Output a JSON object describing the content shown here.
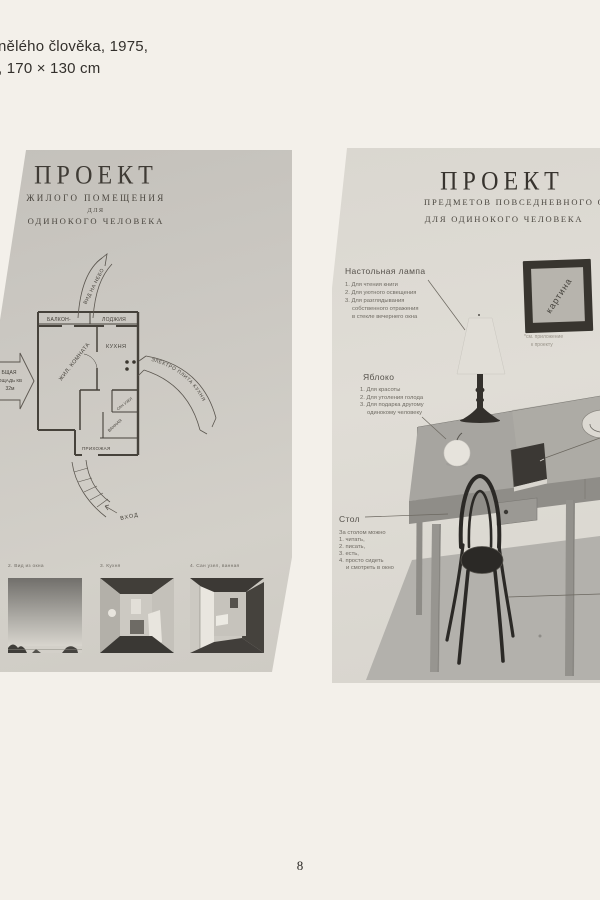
{
  "colors": {
    "page_bg": "#f3f0ea",
    "panel_left_bg": "#c9c6c0",
    "panel_right_bg": "#dedbd4",
    "ink": "#3c3833",
    "faint_ink": "#6b675f"
  },
  "caption": {
    "line1": "nělého člověka, 1975,",
    "line2": ", 170 × 130 cm"
  },
  "page_number": "8",
  "left_artwork": {
    "title": "ПРОЕКТ",
    "subtitle_line1": "ЖИЛОГО  ПОМЕЩЕНИЯ",
    "subtitle_line2": "ДЛЯ",
    "subtitle_line3": "ОДИНОКОГО ЧЕЛОВЕКА",
    "plan": {
      "balcony": "БАЛКОН-",
      "loggia": "ЛОДЖИЯ",
      "living_room": "ЖИЛ. КОМНАТА",
      "kitchen": "КУХНЯ",
      "san_uzel": "САН УЗЕЛ",
      "bath": "ВАННАЯ",
      "hallway": "ПРИХОЖАЯ",
      "sky_view_arrow": "ВИД НА НЕБО",
      "area_line1": "БЩАЯ",
      "area_line2": "ОЩАДЬ КВ",
      "area_line3": "32м",
      "stove_arrow": "ЭЛЕКТРО ПЛИТА КУХНЯ",
      "entrance_arrow": "ВХОД"
    },
    "photo_captions": [
      "2. Вид из окна",
      "3. Кухня",
      "4. Сан узел, ванная"
    ]
  },
  "right_artwork": {
    "title": "ПРОЕКТ",
    "subtitle_line1": "ПРЕДМЕТОВ ПОВСЕДНЕВНОГО ОБИХОДА",
    "subtitle_line2": "ДЛЯ ОДИНОКОГО ЧЕЛОВЕКА",
    "lamp_note": {
      "title": "Настольная лампа",
      "lines": [
        "1. Для чтения книги",
        "2. Для уютного освещения",
        "3. Для разглядывания",
        "собственного отражения",
        "в стекле вечернего окна"
      ]
    },
    "apple_note": {
      "title": "Яблоко",
      "lines": [
        "1. Для красоты",
        "2. Для утоления голода",
        "3. Для подарка другому",
        "одинокому человеку"
      ]
    },
    "table_note": {
      "title": "Стол",
      "lines": [
        "За столом можно",
        "1. читать,",
        "2. писать,",
        "3. есть,",
        "4. просто сидеть",
        "и смотреть в окно"
      ]
    },
    "picture_label": "картина",
    "picture_note_line1": "*см. приложение",
    "picture_note_line2": "к проекту"
  }
}
